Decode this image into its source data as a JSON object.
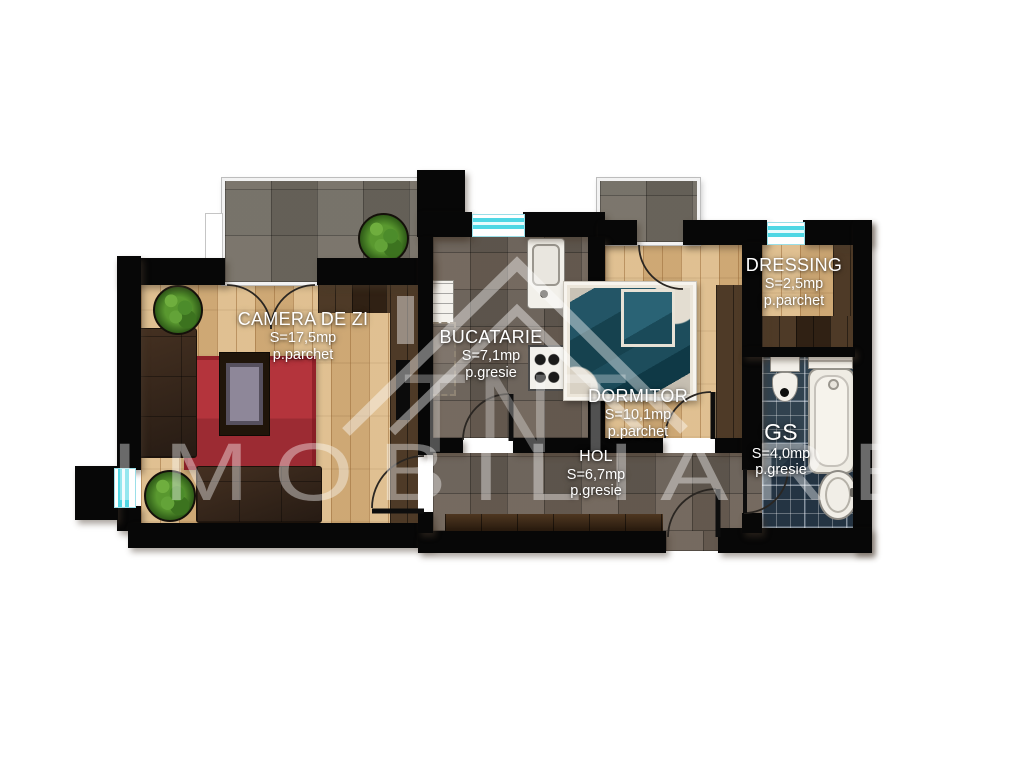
{
  "plan": {
    "rooms": [
      {
        "key": "living",
        "name": "CAMERA DE ZI",
        "area": "S=17,5mp",
        "flooring": "p.parchet"
      },
      {
        "key": "kitchen",
        "name": "BUCATARIE",
        "area": "S=7,1mp",
        "flooring": "p.gresie"
      },
      {
        "key": "bedroom",
        "name": "DORMITOR",
        "area": "S=10,1mp",
        "flooring": "p.parchet"
      },
      {
        "key": "hall",
        "name": "HOL",
        "area": "S=6,7mp",
        "flooring": "p.gresie"
      },
      {
        "key": "dressing",
        "name": "DRESSING",
        "area": "S=2,5mp",
        "flooring": "p.parchet"
      },
      {
        "key": "bath",
        "name": "GS",
        "area": "S=4,0mp",
        "flooring": "p.gresie"
      }
    ],
    "watermark": {
      "initials": "TNT",
      "name": "IMOBILIARE"
    },
    "colors": {
      "wall": "#070707",
      "window_accent": "#4fd7e4",
      "bath_tile": "#2b3b4b",
      "rug": "#b03038",
      "wood_light": "#d9b581",
      "wood_dark": "#3a2818",
      "stone": "#746a60"
    }
  }
}
